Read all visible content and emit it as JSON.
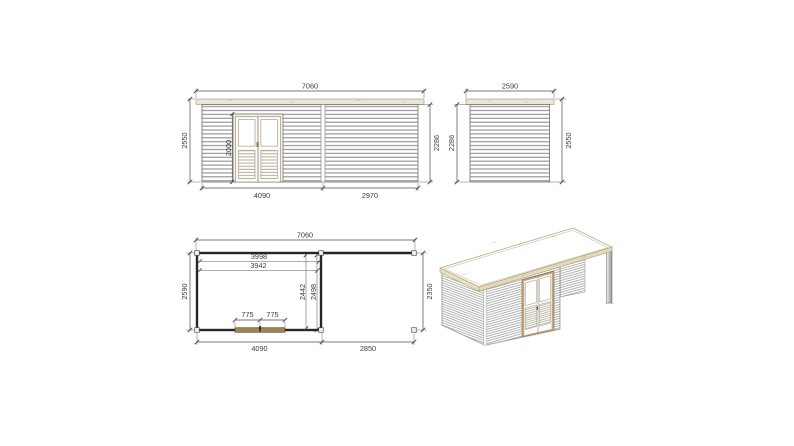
{
  "page": {
    "background": "#ffffff",
    "description": "Technical dimension drawing of a flat-roof garden house with side canopy: front elevation, side elevation, floor plan and 3D perspective view"
  },
  "colors": {
    "line": "#4d4d4d",
    "wall_outline": "#6e6e6e",
    "slat_line": "#8f8f8f",
    "roof_wood": "#ece5d3",
    "roof_trim": "#9b9383",
    "door_wood_3d": "#cfae7e",
    "plan_door_wood": "#ac8d5c",
    "plan_wall": "#262626",
    "post_gray": "#9a9a9a",
    "text": "#3c3c3c"
  },
  "views": {
    "front_elevation": {
      "dims": {
        "total_width": "7060",
        "height_total": "2550",
        "height_wall": "2286",
        "door_height": "2000",
        "section_left": "4090",
        "section_right": "2970"
      }
    },
    "side_elevation": {
      "dims": {
        "width": "2590",
        "height_wall": "2286",
        "height_total": "2550"
      }
    },
    "floor_plan": {
      "dims": {
        "total_width": "7060",
        "interior_width_a": "3998",
        "interior_width_b": "3942",
        "depth_total": "2590",
        "interior_depth_a": "2442",
        "interior_depth_b": "2498",
        "canopy_depth": "2350",
        "door_leaf_left": "775",
        "door_leaf_right": "775",
        "room_width": "4090",
        "canopy_width": "2850"
      }
    }
  }
}
